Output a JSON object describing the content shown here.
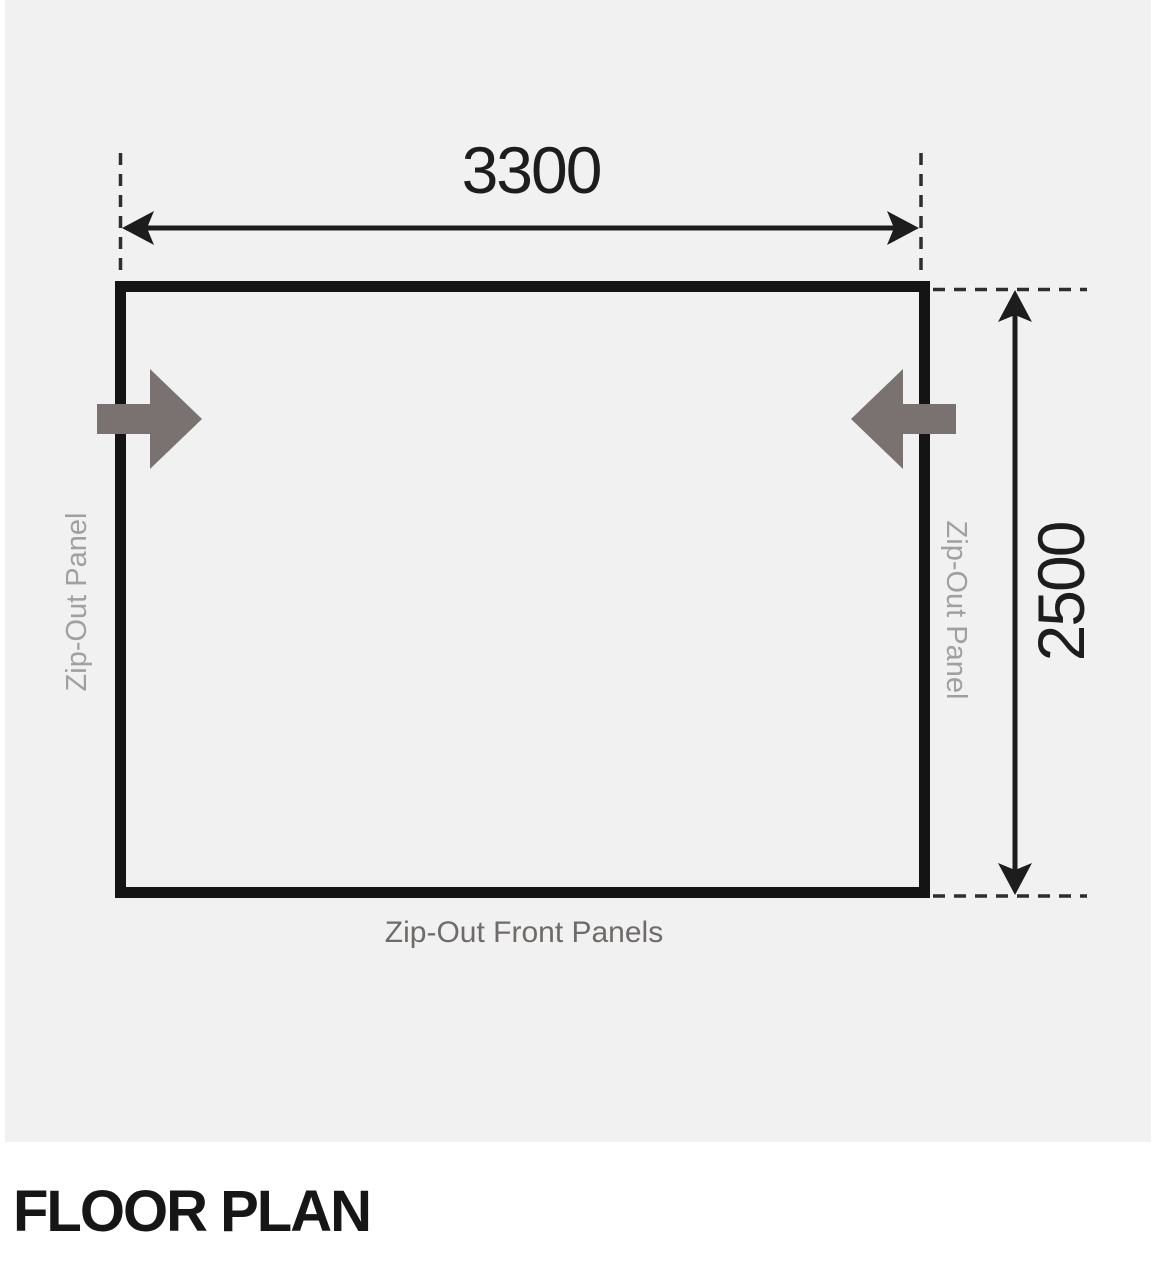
{
  "header": {
    "title": "FLOOR PLAN"
  },
  "diagram": {
    "width_label": "3300",
    "height_label": "2500",
    "left_panel_label": "Zip-Out Panel",
    "right_panel_label": "Zip-Out Panel",
    "front_panel_label": "Zip-Out Front Panels"
  },
  "colors": {
    "panel_background": "#f1f1f2",
    "wall_black": "#141414",
    "dimension_black": "#1d1d1d",
    "door_arrow_gray": "#7a7270",
    "side_label_gray": "#a2a09e",
    "front_label_gray": "#6e6b69"
  }
}
